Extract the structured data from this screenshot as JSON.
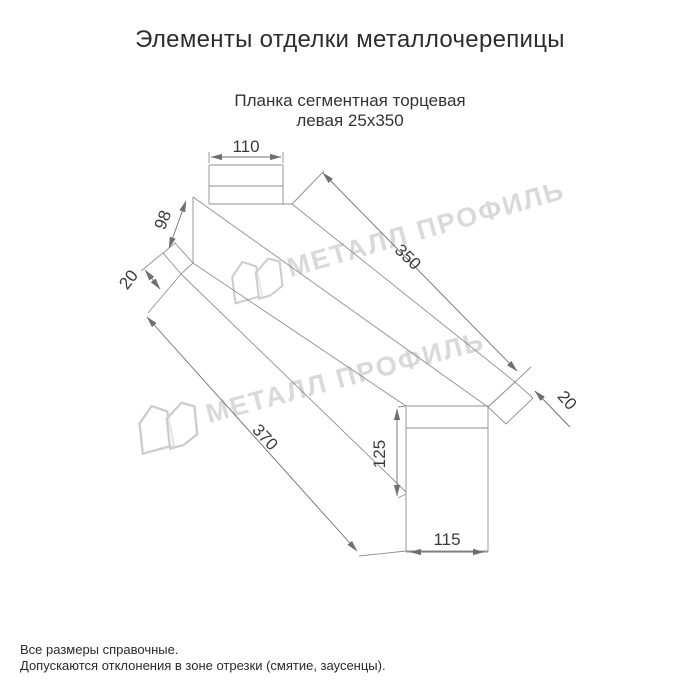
{
  "page": {
    "title": "Элементы отделки металлочерепицы",
    "subtitle": {
      "line1": "Планка сегментная торцевая",
      "line2": "левая 25х350"
    },
    "notes": {
      "line1": "Все размеры справочные.",
      "line2": "Допускаются отклонения в зоне отрезки (смятие, заусенцы)."
    }
  },
  "drawing": {
    "type": "technical-drawing",
    "dims": {
      "top_flange_width": "110",
      "left_face_height": "98",
      "left_hem": "20",
      "length_top": "350",
      "right_hem": "20",
      "length_bottom": "370",
      "end_face_height": "125",
      "end_face_width": "115"
    },
    "line_color": "#8f8f8f",
    "dim_text_color": "#3a3a3a"
  },
  "watermark": {
    "text": "МЕТАЛЛ ПРОФИЛЬ",
    "color": "#d0d0d0"
  }
}
